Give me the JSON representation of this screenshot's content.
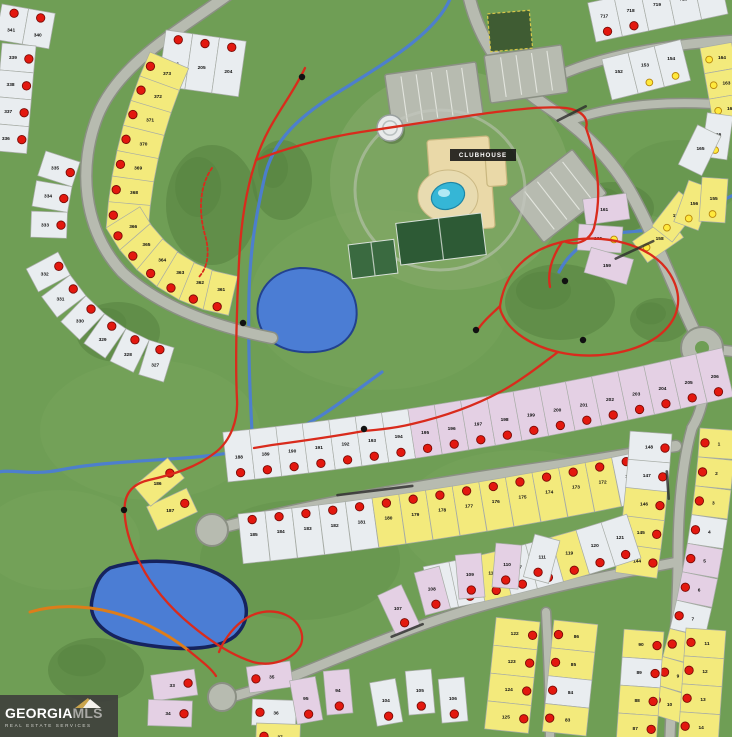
{
  "map": {
    "clubhouse_label": "CLUBHOUSE",
    "colors": {
      "grass": "#6f9e55",
      "grass_light": "#7aa75f",
      "grass_dark": "#5f8d49",
      "tree": "#55813f",
      "road_fill": "#b7bbb0",
      "road_casing": "#8b9084",
      "lot_white": "#e9edf0",
      "lot_yellow": "#f3ea7c",
      "lot_pink": "#e4d0e4",
      "lot_stroke": "#a7aca6",
      "pond": "#4b7dd4",
      "pond_edge": "#22418f",
      "pond2_edge": "#16235e",
      "stream": "#4b7dd4",
      "trail_red": "#d92b1c",
      "trail_orange": "#dd7d1a",
      "sold_dot": "#e3180f",
      "sold_dot_edge": "#7a0b06",
      "avail_dot": "#ffe93c",
      "avail_dot_edge": "#b8860b",
      "building": "#ead9a8",
      "building_edge": "#c9b77f",
      "pool": "#35b6d6",
      "court": "#2d5a35",
      "court2": "#3a6a40",
      "tower": "#e8eaea",
      "label_bg": "#141414",
      "number": "#101010"
    },
    "grass_patches_light": [
      [
        380,
        300,
        130,
        90
      ],
      [
        150,
        430,
        110,
        70
      ],
      [
        520,
        520,
        120,
        70
      ],
      [
        60,
        540,
        80,
        50
      ]
    ],
    "grass_patches_dark": [
      [
        300,
        560,
        100,
        60
      ],
      [
        680,
        180,
        60,
        40
      ]
    ],
    "trees": [
      [
        212,
        205,
        46,
        60
      ],
      [
        118,
        332,
        42,
        30
      ],
      [
        612,
        208,
        42,
        26
      ],
      [
        560,
        302,
        55,
        38
      ],
      [
        96,
        670,
        48,
        32
      ],
      [
        282,
        180,
        30,
        40
      ],
      [
        660,
        320,
        30,
        22
      ]
    ],
    "clubhouse_green": [
      450,
      180,
      120,
      110
    ],
    "roads": [
      {
        "d": "M232,-8 C180,30 120,62 98,115 C78,165 82,228 122,272 C158,306 212,326 272,338",
        "w": 10
      },
      {
        "d": "M468,-8 C478,40 505,78 545,105 C575,125 605,150 628,188 C650,225 675,290 690,322 C696,335 700,342 702,348",
        "w": 11
      },
      {
        "d": "M528,92 C575,62 640,46 738,40",
        "w": 9
      },
      {
        "d": "M572,120 C620,103 680,100 738,106",
        "w": 8
      },
      {
        "d": "M702,348 L738,352",
        "w": 9
      },
      {
        "d": "M705,369 C706,395 700,415 692,428",
        "w": 9
      },
      {
        "d": "M692,428 C680,470 678,520 678,560 C678,610 672,680 670,737",
        "w": 9
      },
      {
        "d": "M220,528 C320,502 430,484 540,468 C610,458 650,450 676,446",
        "w": 10
      },
      {
        "d": "M678,562 C610,575 524,592 452,615 C399,632 334,660 289,678 C266,687 249,692 235,696",
        "w": 9
      },
      {
        "d": "M546,612 C548,650 550,700 550,737",
        "w": 8
      }
    ],
    "roundabout": {
      "x": 702,
      "y": 348,
      "r": 21
    },
    "culdesacs": [
      {
        "x": 212,
        "y": 530,
        "r": 16
      },
      {
        "x": 222,
        "y": 697,
        "r": 14
      }
    ],
    "parkings": [
      {
        "x": 388,
        "y": 68,
        "w": 92,
        "h": 54,
        "rot": -8,
        "stripes": 6
      },
      {
        "x": 487,
        "y": 50,
        "w": 78,
        "h": 48,
        "rot": -8,
        "stripes": 5
      },
      {
        "x": 518,
        "y": 168,
        "w": 80,
        "h": 56,
        "rot": -38,
        "stripes": 5
      }
    ],
    "garden_square": {
      "x": 489,
      "y": 12,
      "w": 42,
      "h": 38,
      "rot": -5
    },
    "buildings": [
      {
        "x": 430,
        "y": 138,
        "w": 62,
        "h": 92,
        "rot": -4
      },
      {
        "x": 486,
        "y": 152,
        "w": 20,
        "h": 34,
        "rot": -4
      }
    ],
    "pool_deck": {
      "x": 448,
      "y": 196,
      "rx": 30,
      "ry": 26
    },
    "pool": {
      "x": 448,
      "y": 196,
      "rx": 17,
      "ry": 13,
      "rot": -20
    },
    "courts": [
      {
        "x": 398,
        "y": 218,
        "w": 86,
        "h": 42,
        "rot": -7,
        "light": false
      },
      {
        "x": 350,
        "y": 242,
        "w": 46,
        "h": 34,
        "rot": -7,
        "light": true
      }
    ],
    "water_tower": {
      "x": 390,
      "y": 128,
      "r": 13
    },
    "clubhouse_label_box": {
      "x": 450,
      "y": 149,
      "w": 66,
      "h": 12
    },
    "ponds": [
      {
        "d": "M300,268 C330,268 352,282 356,305 C360,330 345,350 315,352 C285,354 262,342 258,318 C254,292 272,270 300,268 Z",
        "edge": "pond_edge",
        "ew": 2
      },
      {
        "d": "M110,568 C150,556 200,560 228,580 C250,596 252,620 235,636 C215,652 175,650 140,644 C105,638 88,620 92,600 C95,584 100,574 110,568 Z",
        "edge": "pond2_edge",
        "ew": 3.5
      }
    ],
    "streams": [
      "M452,-6 C440,30 390,60 345,88 C300,115 272,140 264,180 C256,215 250,250 249,295 C248,340 250,400 253,448",
      "M253,448 C200,462 120,458 60,470 C30,476 10,468 -6,473",
      "M382,372 C350,395 320,420 290,432 C275,438 262,442 253,448",
      "M738,193 C710,205 688,222 660,228 C630,234 612,230 592,240 C577,247 566,258 559,272"
    ],
    "trails_red": [
      "M305,68 C290,100 268,122 256,160 C246,190 241,222 239,262 C237,300 235,360 237,400 C238,420 231,440 216,452 C196,468 171,475 149,480 C136,483 127,490 125,503 C123,520 129,545 141,565 C151,585 169,607 191,625 C209,640 231,655 253,662 C271,667 291,660 299,648 C306,638 301,622 286,615 C271,608 253,612 241,622 C231,630 223,642 219,652",
      "M256,160 C281,150 321,138 361,132 C401,126 451,118 496,112 C521,109 546,106 566,108 C581,110 589,118 586,128",
      "M500,306 C505,272 527,250 562,242 C602,232 652,244 670,274 C684,297 680,320 657,337 C632,354 592,360 558,352 C532,346 510,332 502,314 C500,310 500,308 500,306 Z",
      "M558,352 C542,364 522,380 500,392 C472,407 442,417 412,424 C392,429 374,430 364,431 C342,435 302,441 272,445 C266,446 260,447 254,448",
      "M586,128 C598,162 602,196 594,228 C590,240 578,246 566,242",
      "M562,242 C552,257 547,272 550,287",
      "M500,306 C492,314 482,322 477,331",
      "M188,650 C200,660 211,668 216,676"
    ],
    "trail_dashed": "M212,168 C200,185 198,210 205,235 C210,252 208,268 198,278",
    "trail_orange": "M30,612 C60,603 95,606 125,616 C150,624 170,636 188,650",
    "trail_markers": [
      [
        302,
        77
      ],
      [
        243,
        323
      ],
      [
        364,
        429
      ],
      [
        476,
        330
      ],
      [
        565,
        281
      ],
      [
        583,
        340
      ],
      [
        124,
        510
      ]
    ],
    "street_labels": [
      {
        "x": 556,
        "y": 120,
        "len": 34,
        "rot": -27
      },
      {
        "x": 614,
        "y": 258,
        "len": 44,
        "rot": -25
      },
      {
        "x": 336,
        "y": 494,
        "len": 78,
        "rot": -7
      },
      {
        "x": 668,
        "y": 470,
        "len": 30,
        "rot": 86
      },
      {
        "x": 390,
        "y": 636,
        "len": 36,
        "rot": -22
      }
    ],
    "lot_strips": [
      {
        "x": 166,
        "y": 30,
        "a": 8,
        "c": 0,
        "side": 1,
        "w": 27,
        "d": 56,
        "n": 3,
        "cols": "WWW",
        "nums": [
          "206",
          "205",
          "204"
        ],
        "dots": "r",
        "di": 8,
        "ni": 32
      },
      {
        "x": 2,
        "y": 4,
        "a": 10,
        "c": 0,
        "side": 1,
        "w": 27,
        "d": 36,
        "n": 2,
        "cols": "WW",
        "nums": [
          "341",
          "340"
        ],
        "dots": "r",
        "di": 7,
        "ni": 24
      },
      {
        "x": 36,
        "y": 46,
        "a": 95,
        "c": 0,
        "side": 1,
        "w": 27,
        "d": 34,
        "n": 4,
        "cols": "WWWW",
        "nums": [
          "339",
          "338",
          "337",
          "336"
        ],
        "dots": "r",
        "di": 6,
        "ni": 22
      },
      {
        "x": 80,
        "y": 162,
        "a": 108,
        "c": -8,
        "side": 1,
        "w": 26,
        "d": 36,
        "n": 3,
        "cols": "WWW",
        "nums": [
          "335",
          "334",
          "333"
        ],
        "dots": "r",
        "di": 6,
        "ni": 22
      },
      {
        "x": 58,
        "y": 252,
        "a": 62,
        "c": -9,
        "side": 1,
        "w": 26,
        "d": 36,
        "n": 6,
        "cols": "WWWWWW",
        "nums": [
          "332",
          "331",
          "330",
          "329",
          "328",
          "327"
        ],
        "dots": "r",
        "di": 6,
        "ni": 22
      },
      {
        "x": 150,
        "y": 52,
        "a": 113,
        "c": -3,
        "side": -1,
        "w": 26,
        "d": 42,
        "n": 7,
        "cols": "YYYYYYY",
        "nums": [
          "373",
          "372",
          "371",
          "370",
          "369",
          "368",
          "367"
        ],
        "dots": "r",
        "di": 6,
        "ni": 24
      },
      {
        "x": 106,
        "y": 228,
        "a": 58,
        "c": -9,
        "side": -1,
        "w": 26,
        "d": 40,
        "n": 6,
        "cols": "YYYYYY",
        "nums": [
          "366",
          "365",
          "364",
          "363",
          "362",
          "361"
        ],
        "dots": "r",
        "di": 6,
        "ni": 24
      },
      {
        "x": 596,
        "y": 42,
        "a": -12,
        "c": 0,
        "side": -1,
        "w": 27,
        "d": 40,
        "n": 5,
        "cols": "WWWWW",
        "nums": [
          "717",
          "718",
          "719",
          "720",
          "721"
        ],
        "dots": [
          "r",
          "r",
          null,
          null,
          null
        ],
        "di": 8,
        "ni": 24
      },
      {
        "x": 700,
        "y": 48,
        "a": 80,
        "c": 0,
        "side": -1,
        "w": 26,
        "d": 32,
        "n": 3,
        "cols": "YYY",
        "nums": [
          "164",
          "163",
          "162"
        ],
        "dots": "y",
        "di": 7,
        "ni": 20
      },
      {
        "x": 612,
        "y": 100,
        "a": -14,
        "c": 0,
        "side": -1,
        "w": 27,
        "d": 42,
        "n": 3,
        "cols": "WWW",
        "nums": [
          "152",
          "153",
          "154"
        ],
        "dots": [
          null,
          "y",
          "y"
        ],
        "di": 8,
        "ni": 26
      },
      {
        "x": 228,
        "y": 482,
        "a": -6,
        "c": -0.4,
        "side": -1,
        "w": 27,
        "d": 50,
        "n": 19,
        "cols": "WWWWWWWPPPPPPPPPPPP",
        "nums": [
          "188",
          "189",
          "190",
          "191",
          "192",
          "193",
          "194",
          "195",
          "196",
          "197",
          "198",
          "199",
          "200",
          "201",
          "202",
          "203",
          "204",
          "205",
          "206"
        ],
        "dots": "r",
        "di": 8,
        "ni": 24
      },
      {
        "x": 238,
        "y": 514,
        "a": -6,
        "c": -0.4,
        "side": 1,
        "w": 27,
        "d": 50,
        "n": 15,
        "cols": "WWWWWYYYYYYYYYW",
        "nums": [
          "185",
          "184",
          "183",
          "182",
          "181",
          "180",
          "179",
          "178",
          "177",
          "176",
          "175",
          "174",
          "173",
          "172",
          "171"
        ],
        "dots": "r",
        "di": 7,
        "ni": 22
      },
      {
        "x": 700,
        "y": 428,
        "a": 94,
        "c": 1.5,
        "side": -1,
        "w": 29,
        "d": 36,
        "n": 10,
        "cols": "YYYWPPWYYY",
        "nums": [
          "1",
          "2",
          "3",
          "4",
          "5",
          "6",
          "7",
          "8",
          "9",
          "10"
        ],
        "dots": "r",
        "di": 6,
        "ni": 20
      },
      {
        "x": 672,
        "y": 434,
        "a": 94,
        "c": 1,
        "side": 1,
        "w": 29,
        "d": 42,
        "n": 5,
        "cols": "WWYYY",
        "nums": [
          "148",
          "147",
          "146",
          "145",
          "144"
        ],
        "dots": "r",
        "di": 6,
        "ni": 22
      },
      {
        "x": 432,
        "y": 612,
        "a": -11,
        "c": -1,
        "side": -1,
        "w": 27,
        "d": 46,
        "n": 8,
        "cols": "WWYWWYWW",
        "nums": [
          "114",
          "115",
          "116",
          "117",
          "118",
          "119",
          "120",
          "121"
        ],
        "dots": "r",
        "di": 8,
        "ni": 26
      },
      {
        "x": 540,
        "y": 622,
        "a": 96,
        "c": 0,
        "side": 1,
        "w": 28,
        "d": 44,
        "n": 4,
        "cols": "YYYY",
        "nums": [
          "122",
          "123",
          "124",
          "125"
        ],
        "dots": "r",
        "di": 6,
        "ni": 24
      },
      {
        "x": 554,
        "y": 620,
        "a": 96,
        "c": 0,
        "side": -1,
        "w": 28,
        "d": 44,
        "n": 4,
        "cols": "YYWY",
        "nums": [
          "86",
          "85",
          "84",
          "83"
        ],
        "dots": "r",
        "di": 6,
        "ni": 24
      },
      {
        "x": 664,
        "y": 632,
        "a": 94,
        "c": 0,
        "side": 1,
        "w": 28,
        "d": 40,
        "n": 4,
        "cols": "YWYY",
        "nums": [
          "90",
          "89",
          "88",
          "87"
        ],
        "dots": "r",
        "di": 6,
        "ni": 22
      },
      {
        "x": 686,
        "y": 628,
        "a": 94,
        "c": 0,
        "side": -1,
        "w": 28,
        "d": 40,
        "n": 4,
        "cols": "YYYY",
        "nums": [
          "11",
          "12",
          "13",
          "14"
        ],
        "dots": "r",
        "di": 6,
        "ni": 22
      }
    ],
    "lot_singles": [
      {
        "x": 640,
        "y": 252,
        "r": -35,
        "c": "Y",
        "n": "158",
        "dot": "y"
      },
      {
        "x": 662,
        "y": 234,
        "r": -52,
        "c": "Y",
        "n": "157",
        "dot": "y"
      },
      {
        "x": 686,
        "y": 226,
        "r": -70,
        "c": "Y",
        "n": "156",
        "dot": "y"
      },
      {
        "x": 712,
        "y": 222,
        "r": -86,
        "c": "Y",
        "n": "155",
        "dot": "y"
      },
      {
        "x": 628,
        "y": 206,
        "r": 172,
        "c": "P",
        "n": "161",
        "dot": null
      },
      {
        "x": 622,
        "y": 240,
        "r": 184,
        "c": "P",
        "n": "160",
        "dot": "y"
      },
      {
        "x": 630,
        "y": 272,
        "r": 196,
        "c": "P",
        "n": "159",
        "dot": null
      },
      {
        "x": 714,
        "y": 158,
        "r": -82,
        "c": "W",
        "n": "166",
        "dot": "y"
      },
      {
        "x": 690,
        "y": 170,
        "r": -64,
        "c": "W",
        "n": "165",
        "dot": null
      },
      {
        "x": 192,
        "y": 500,
        "r": 155,
        "c": "Y",
        "n": "187",
        "dot": "r"
      },
      {
        "x": 176,
        "y": 468,
        "r": 140,
        "c": "Y",
        "n": "186",
        "dot": "r"
      },
      {
        "x": 408,
        "y": 630,
        "r": -115,
        "c": "P",
        "n": "107",
        "dot": "r"
      },
      {
        "x": 438,
        "y": 612,
        "r": -105,
        "c": "P",
        "n": "108",
        "dot": "r"
      },
      {
        "x": 472,
        "y": 598,
        "r": -95,
        "c": "P",
        "n": "109",
        "dot": "r"
      },
      {
        "x": 505,
        "y": 588,
        "r": -85,
        "c": "P",
        "n": "110",
        "dot": "r"
      },
      {
        "x": 536,
        "y": 580,
        "r": -75,
        "c": "W",
        "n": "111",
        "dot": "r"
      },
      {
        "x": 196,
        "y": 682,
        "r": 172,
        "c": "P",
        "n": "33",
        "dot": "r"
      },
      {
        "x": 192,
        "y": 714,
        "r": 182,
        "c": "P",
        "n": "34",
        "dot": "r"
      },
      {
        "x": 248,
        "y": 680,
        "r": -8,
        "c": "P",
        "n": "35",
        "dot": "r"
      },
      {
        "x": 252,
        "y": 712,
        "r": 2,
        "c": "W",
        "n": "36",
        "dot": "r"
      },
      {
        "x": 256,
        "y": 736,
        "r": 2,
        "c": "Y",
        "n": "37",
        "dot": "r"
      },
      {
        "x": 310,
        "y": 722,
        "r": -100,
        "c": "P",
        "n": "95",
        "dot": "r"
      },
      {
        "x": 340,
        "y": 714,
        "r": -95,
        "c": "P",
        "n": "94",
        "dot": "r"
      },
      {
        "x": 390,
        "y": 724,
        "r": -100,
        "c": "W",
        "n": "104",
        "dot": "r"
      },
      {
        "x": 422,
        "y": 714,
        "r": -95,
        "c": "W",
        "n": "105",
        "dot": "r"
      },
      {
        "x": 455,
        "y": 722,
        "r": -95,
        "c": "W",
        "n": "106",
        "dot": "r"
      }
    ]
  },
  "watermark": {
    "brand1": "GEORGIA",
    "brand2": "MLS",
    "tagline": "REAL ESTATE SERVICES"
  }
}
